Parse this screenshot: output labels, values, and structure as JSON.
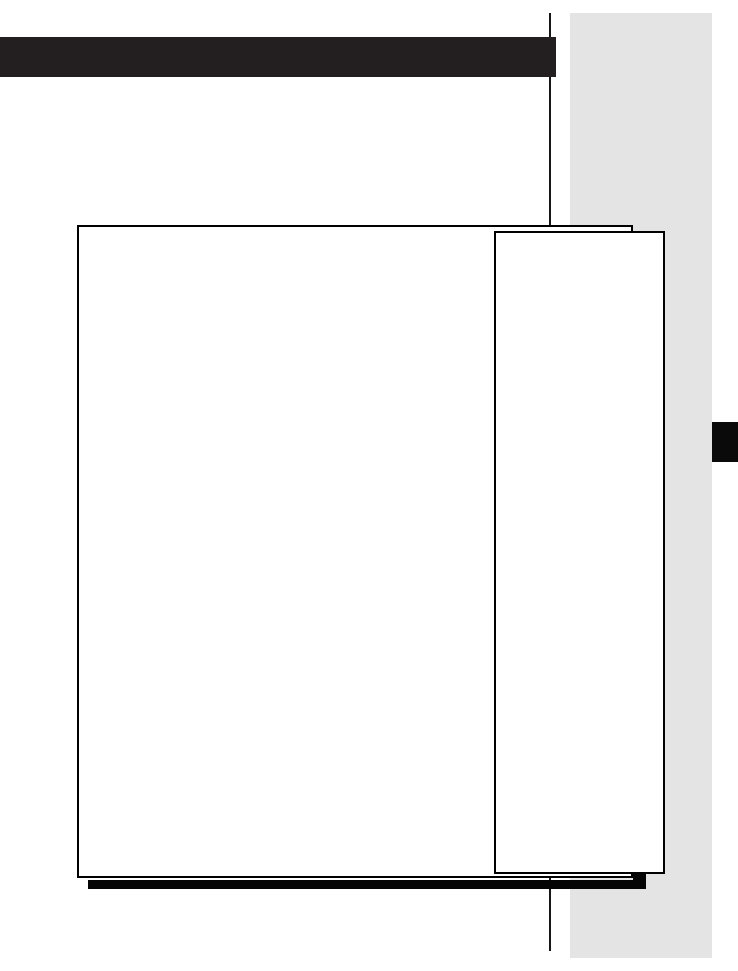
{
  "page": {
    "background": "#ffffff"
  },
  "margin_band": {
    "color": "#e4e4e4"
  },
  "vertical_rule": {
    "color": "#161616"
  },
  "header_bar": {
    "color": "#231f20"
  },
  "edge_tab": {
    "color": "#0a0a0a"
  },
  "shadow_bar": {
    "color": "#050505"
  },
  "shadow_notch": {
    "color": "#050505"
  },
  "main_frame": {
    "fill": "#ffffff",
    "border_color": "#000000"
  },
  "side_frame": {
    "fill": "#ffffff",
    "border_color": "#000000"
  }
}
